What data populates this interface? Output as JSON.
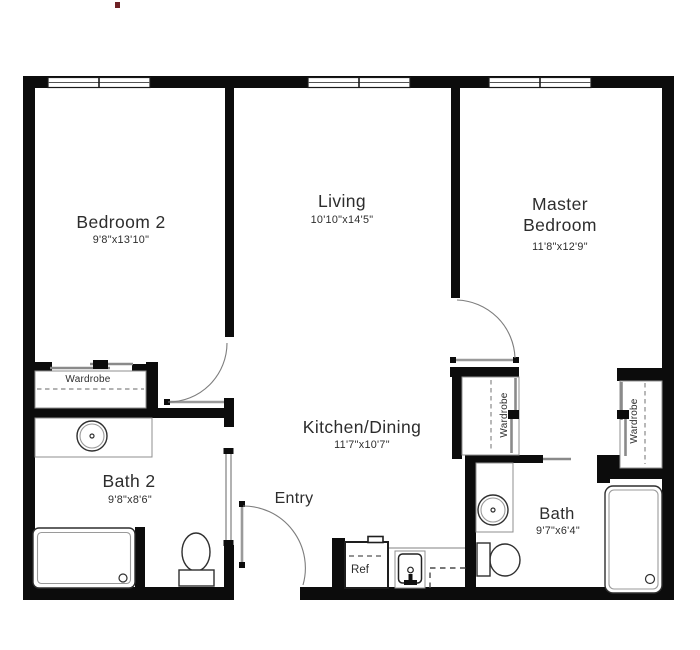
{
  "plan": {
    "rooms": {
      "bedroom2": {
        "name": "Bedroom 2",
        "dims": "9'8\"x13'10\""
      },
      "living": {
        "name": "Living",
        "dims": "10'10\"x14'5\""
      },
      "master": {
        "name_line1": "Master",
        "name_line2": "Bedroom",
        "dims": "11'8\"x12'9\""
      },
      "kitchen": {
        "name": "Kitchen/Dining",
        "dims": "11'7\"x10'7\""
      },
      "bath2": {
        "name": "Bath 2",
        "dims": "9'8\"x8'6\""
      },
      "bath": {
        "name": "Bath",
        "dims": "9'7\"x6'4\""
      },
      "entry": {
        "name": "Entry"
      }
    },
    "fixtures": {
      "wardrobe_bedroom2": "Wardrobe",
      "wardrobe_master_west": "Wardrobe",
      "wardrobe_master_east": "Wardrobe",
      "refrigerator": "Ref"
    },
    "colors": {
      "wall": "#0c0c0c",
      "text": "#2d2d2d",
      "fixture_outline": "#8f8f8f"
    }
  }
}
